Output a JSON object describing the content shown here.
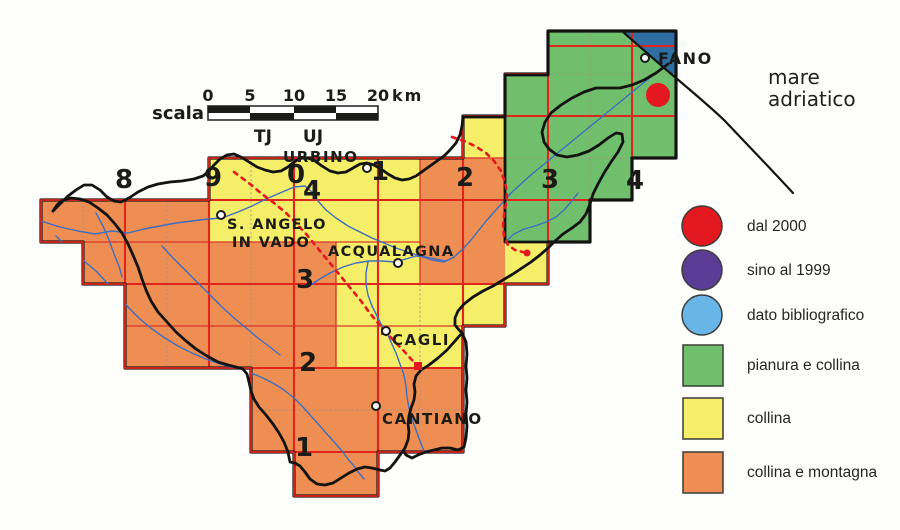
{
  "scale_bar": {
    "label": "scala",
    "ticks": [
      "0",
      "5",
      "10",
      "15",
      "20"
    ],
    "unit": "km",
    "utm_zone_labels": [
      "TJ",
      "UJ"
    ]
  },
  "grid": {
    "column_labels": [
      "8",
      "9",
      "0",
      "1",
      "2",
      "3",
      "4"
    ],
    "row_labels": [
      "4",
      "3",
      "2",
      "1"
    ]
  },
  "sea_label": {
    "line1": "mare",
    "line2": "adriatico"
  },
  "towns": [
    {
      "name": "URBINO"
    },
    {
      "name": "S. ANGELO"
    },
    {
      "name": "IN VADO"
    },
    {
      "name": "ACQUALAGNA"
    },
    {
      "name": "CAGLI"
    },
    {
      "name": "CANTIANO"
    },
    {
      "name": "FANO"
    }
  ],
  "legend": {
    "items": [
      {
        "shape": "circle",
        "color": "#e4191f",
        "label": "dal 2000"
      },
      {
        "shape": "circle",
        "color": "#5b3d97",
        "label": "sino al 1999"
      },
      {
        "shape": "circle",
        "color": "#68b6e7",
        "label": "dato bibliografico"
      },
      {
        "shape": "square",
        "color": "#70bf6c",
        "label": "pianura e collina"
      },
      {
        "shape": "square",
        "color": "#f5ee68",
        "label": "collina"
      },
      {
        "shape": "square",
        "color": "#ef8e53",
        "label": "collina e montagna"
      }
    ]
  },
  "colors": {
    "zone_green": "#70bf6c",
    "zone_yellow": "#f5ee68",
    "zone_orange": "#ef8e53",
    "sea": "#2f6ea3",
    "grid_red": "#e0251c",
    "cell_red": "#d8342a",
    "subgrid": "#a5937d",
    "river": "#3f6ec0",
    "boundary": "#131312",
    "marker_red": "#e4191f"
  }
}
